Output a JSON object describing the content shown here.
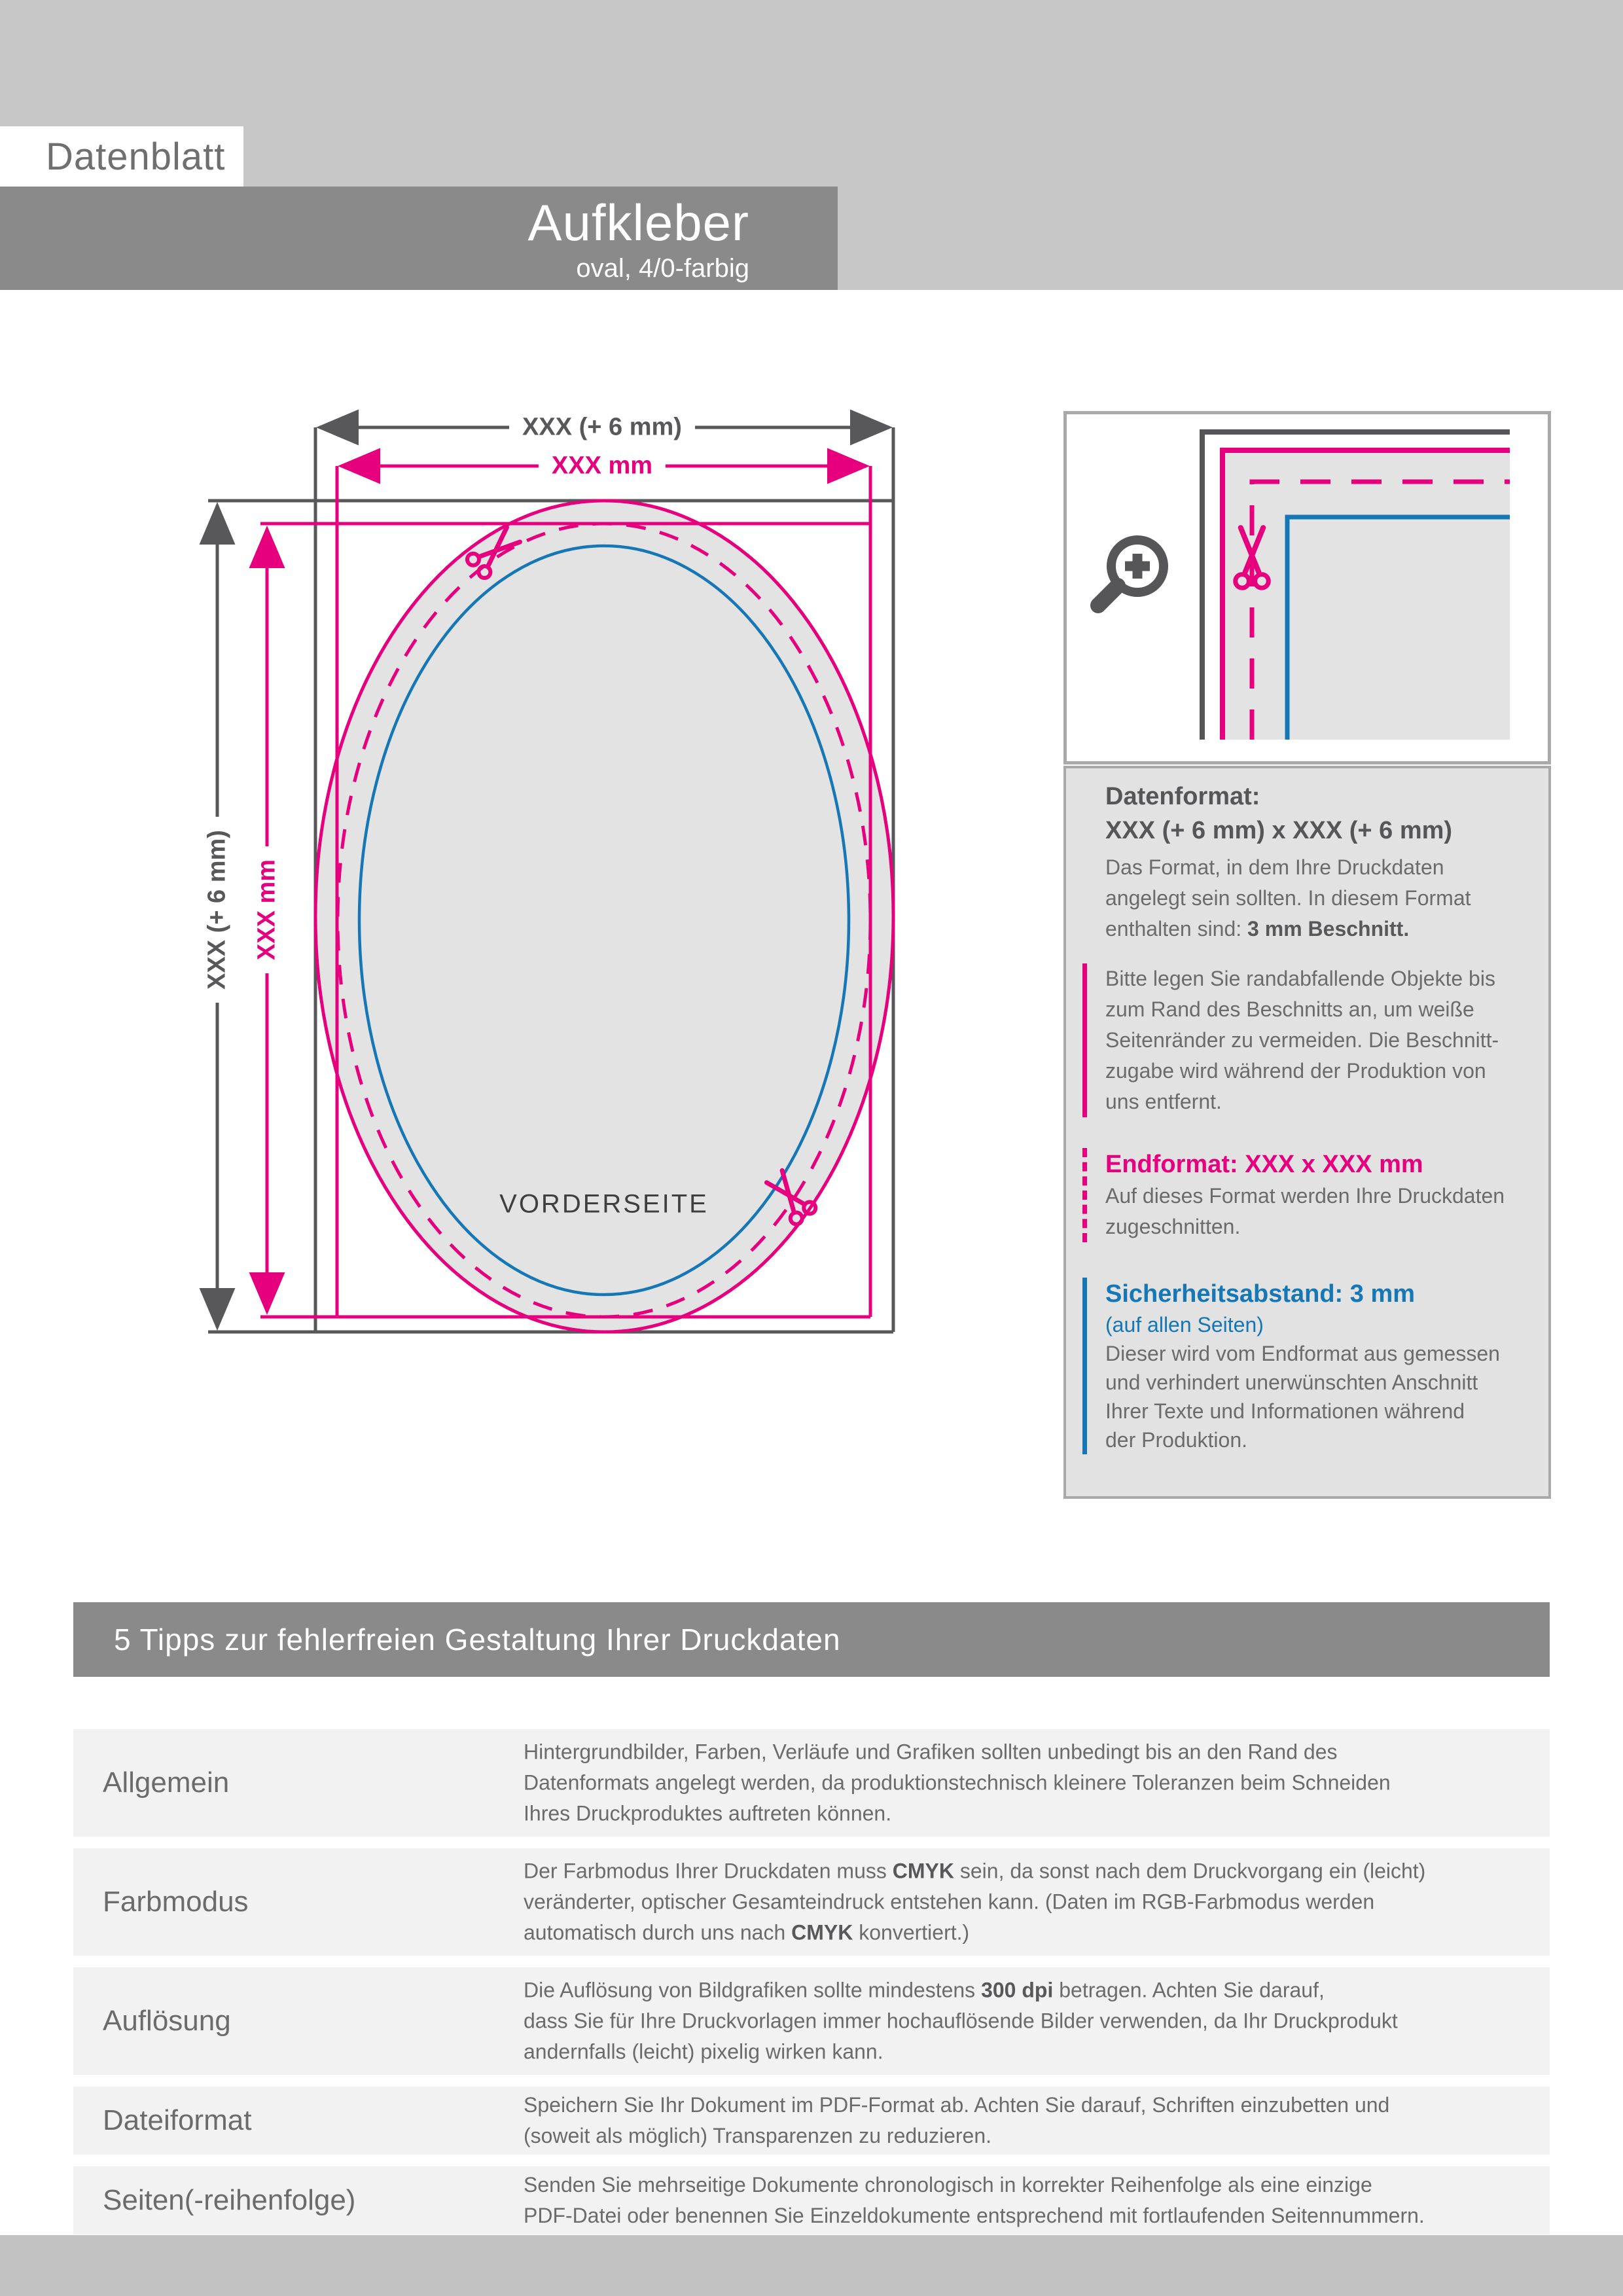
{
  "header": {
    "sheet_label": "Datenblatt",
    "product": "Aufkleber",
    "variant": "oval, 4/0-farbig"
  },
  "diagram": {
    "dim_width_outer": "XXX (+ 6 mm)",
    "dim_width_inner": "XXX mm",
    "dim_height_outer": "XXX (+ 6 mm)",
    "dim_height_inner": "XXX mm",
    "front_label": "VORDERSEITE"
  },
  "panel": {
    "datenformat_title": "Datenformat:",
    "datenformat_value": "XXX (+ 6 mm) x XXX (+ 6 mm)",
    "datenformat_body": [
      "Das Format, in dem Ihre Druckdaten",
      "angelegt sein sollten. In diesem Format",
      "enthalten sind: <b>3 mm Beschnitt.</b>"
    ],
    "bleed_note": [
      "Bitte legen Sie randabfallende Objekte bis",
      "zum Rand des Beschnitts an, um weiße",
      "Seitenränder zu vermeiden. Die Beschnitt-",
      "zugabe wird während der Produktion von",
      "uns entfernt."
    ],
    "endformat_title": "Endformat: XXX x XXX mm",
    "endformat_body": [
      "Auf dieses Format werden Ihre Druckdaten",
      "zugeschnitten."
    ],
    "safety_title": "Sicherheitsabstand: 3 mm",
    "safety_subtitle": "(auf allen Seiten)",
    "safety_body": [
      "Dieser wird vom Endformat aus gemessen",
      "und verhindert unerwünschten Anschnitt",
      "Ihrer Texte und Informationen während",
      "der Produktion."
    ]
  },
  "tips": {
    "title": "5 Tipps zur fehlerfreien Gestaltung Ihrer Druckdaten",
    "rows": [
      {
        "label": "Allgemein",
        "lines": [
          "Hintergrundbilder, Farben, Verläufe und Grafiken sollten unbedingt bis an den Rand des",
          "Datenformats angelegt werden, da produktionstechnisch kleinere Toleranzen beim Schneiden",
          "Ihres Druckproduktes auftreten können."
        ]
      },
      {
        "label": "Farbmodus",
        "lines": [
          "Der Farbmodus Ihrer Druckdaten muss <b>CMYK</b> sein, da sonst nach dem Druckvorgang ein (leicht)",
          "veränderter, optischer Gesamteindruck entstehen kann. (Daten im RGB-Farbmodus werden",
          "automatisch durch uns nach <b>CMYK</b> konvertiert.)"
        ]
      },
      {
        "label": "Auflösung",
        "lines": [
          "Die Auflösung von Bildgrafiken sollte mindestens <b>300 dpi</b> betragen. Achten Sie darauf,",
          "dass Sie für Ihre Druckvorlagen immer hochauflösende Bilder verwenden, da Ihr Druckprodukt",
          "andernfalls (leicht) pixelig wirken kann."
        ]
      },
      {
        "label": "Dateiformat",
        "lines": [
          "Speichern Sie Ihr Dokument im PDF-Format ab. Achten Sie darauf, Schriften einzubetten und",
          "(soweit als möglich) Transparenzen zu reduzieren."
        ]
      },
      {
        "label": "Seiten(-reihenfolge)",
        "lines": [
          "Senden Sie mehrseitige Dokumente chronologisch in korrekter Reihenfolge als eine einzige",
          "PDF-Datei oder benennen Sie Einzeldokumente entsprechend mit fortlaufenden Seitennummern."
        ]
      }
    ]
  },
  "colors": {
    "magenta": "#e6007e",
    "blue": "#1577b5",
    "line_gray": "#58585a",
    "header_bar": "#8a8a8a",
    "band_gray": "#c7c7c7"
  }
}
